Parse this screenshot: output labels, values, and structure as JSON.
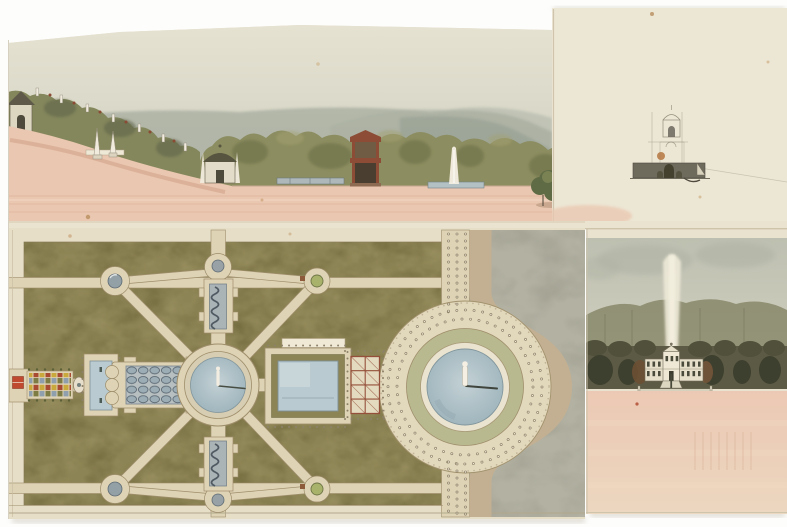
{
  "artwork": {
    "panels": {
      "main_elevation": "Hillside terrace elevation with hedges, pavilions and fountain jet",
      "garden_plan": "Formal parterre garden plan with cascade, pools and circular fountain basin",
      "pavilion_sketch": "Faint pencil elevation sketch of a small domed pavilion",
      "palace_elevation": "Palace elevation with tall fountain jet among dark trees over pink foreground"
    }
  },
  "palette": {
    "backdrop": "#fdfdfc",
    "paper_main": "#e8e1cc",
    "paper_plan": "#e6dec7",
    "paper_right": "#ece6d4",
    "paper_lower_right": "#e9e2cf",
    "path_cream": "#ded3b5",
    "path_line": "#9e8e6b",
    "parterre_green": "#8d8455",
    "parterre_dark": "#6b6438",
    "parterre_light": "#a89e6e",
    "water_blue": "#abc0c7",
    "pool_blue": "#b9cad0",
    "pink_wash": "#eac7b0",
    "pink_band": "#ddb098",
    "sky_gray": "#d6d5c5",
    "mountain": "#a9afa1",
    "mountain_far": "#bcc0b2",
    "tree_olive": "#8c8d60",
    "tree_dark": "#6c6f47",
    "tree_wall": "#5c5a44",
    "tree_wall_dark": "#3e402f",
    "tan_band": "#c3b093",
    "gray_wash": "#b2b1a2",
    "ornament_gray": "#aab3b6",
    "red_marker": "#bf4a2f",
    "tower_red": "#8d4c36",
    "trellis_red": "#94503a",
    "facade_white": "#e6e0cb",
    "plume_white": "#eee9d8",
    "pencil": "#8a8474"
  }
}
